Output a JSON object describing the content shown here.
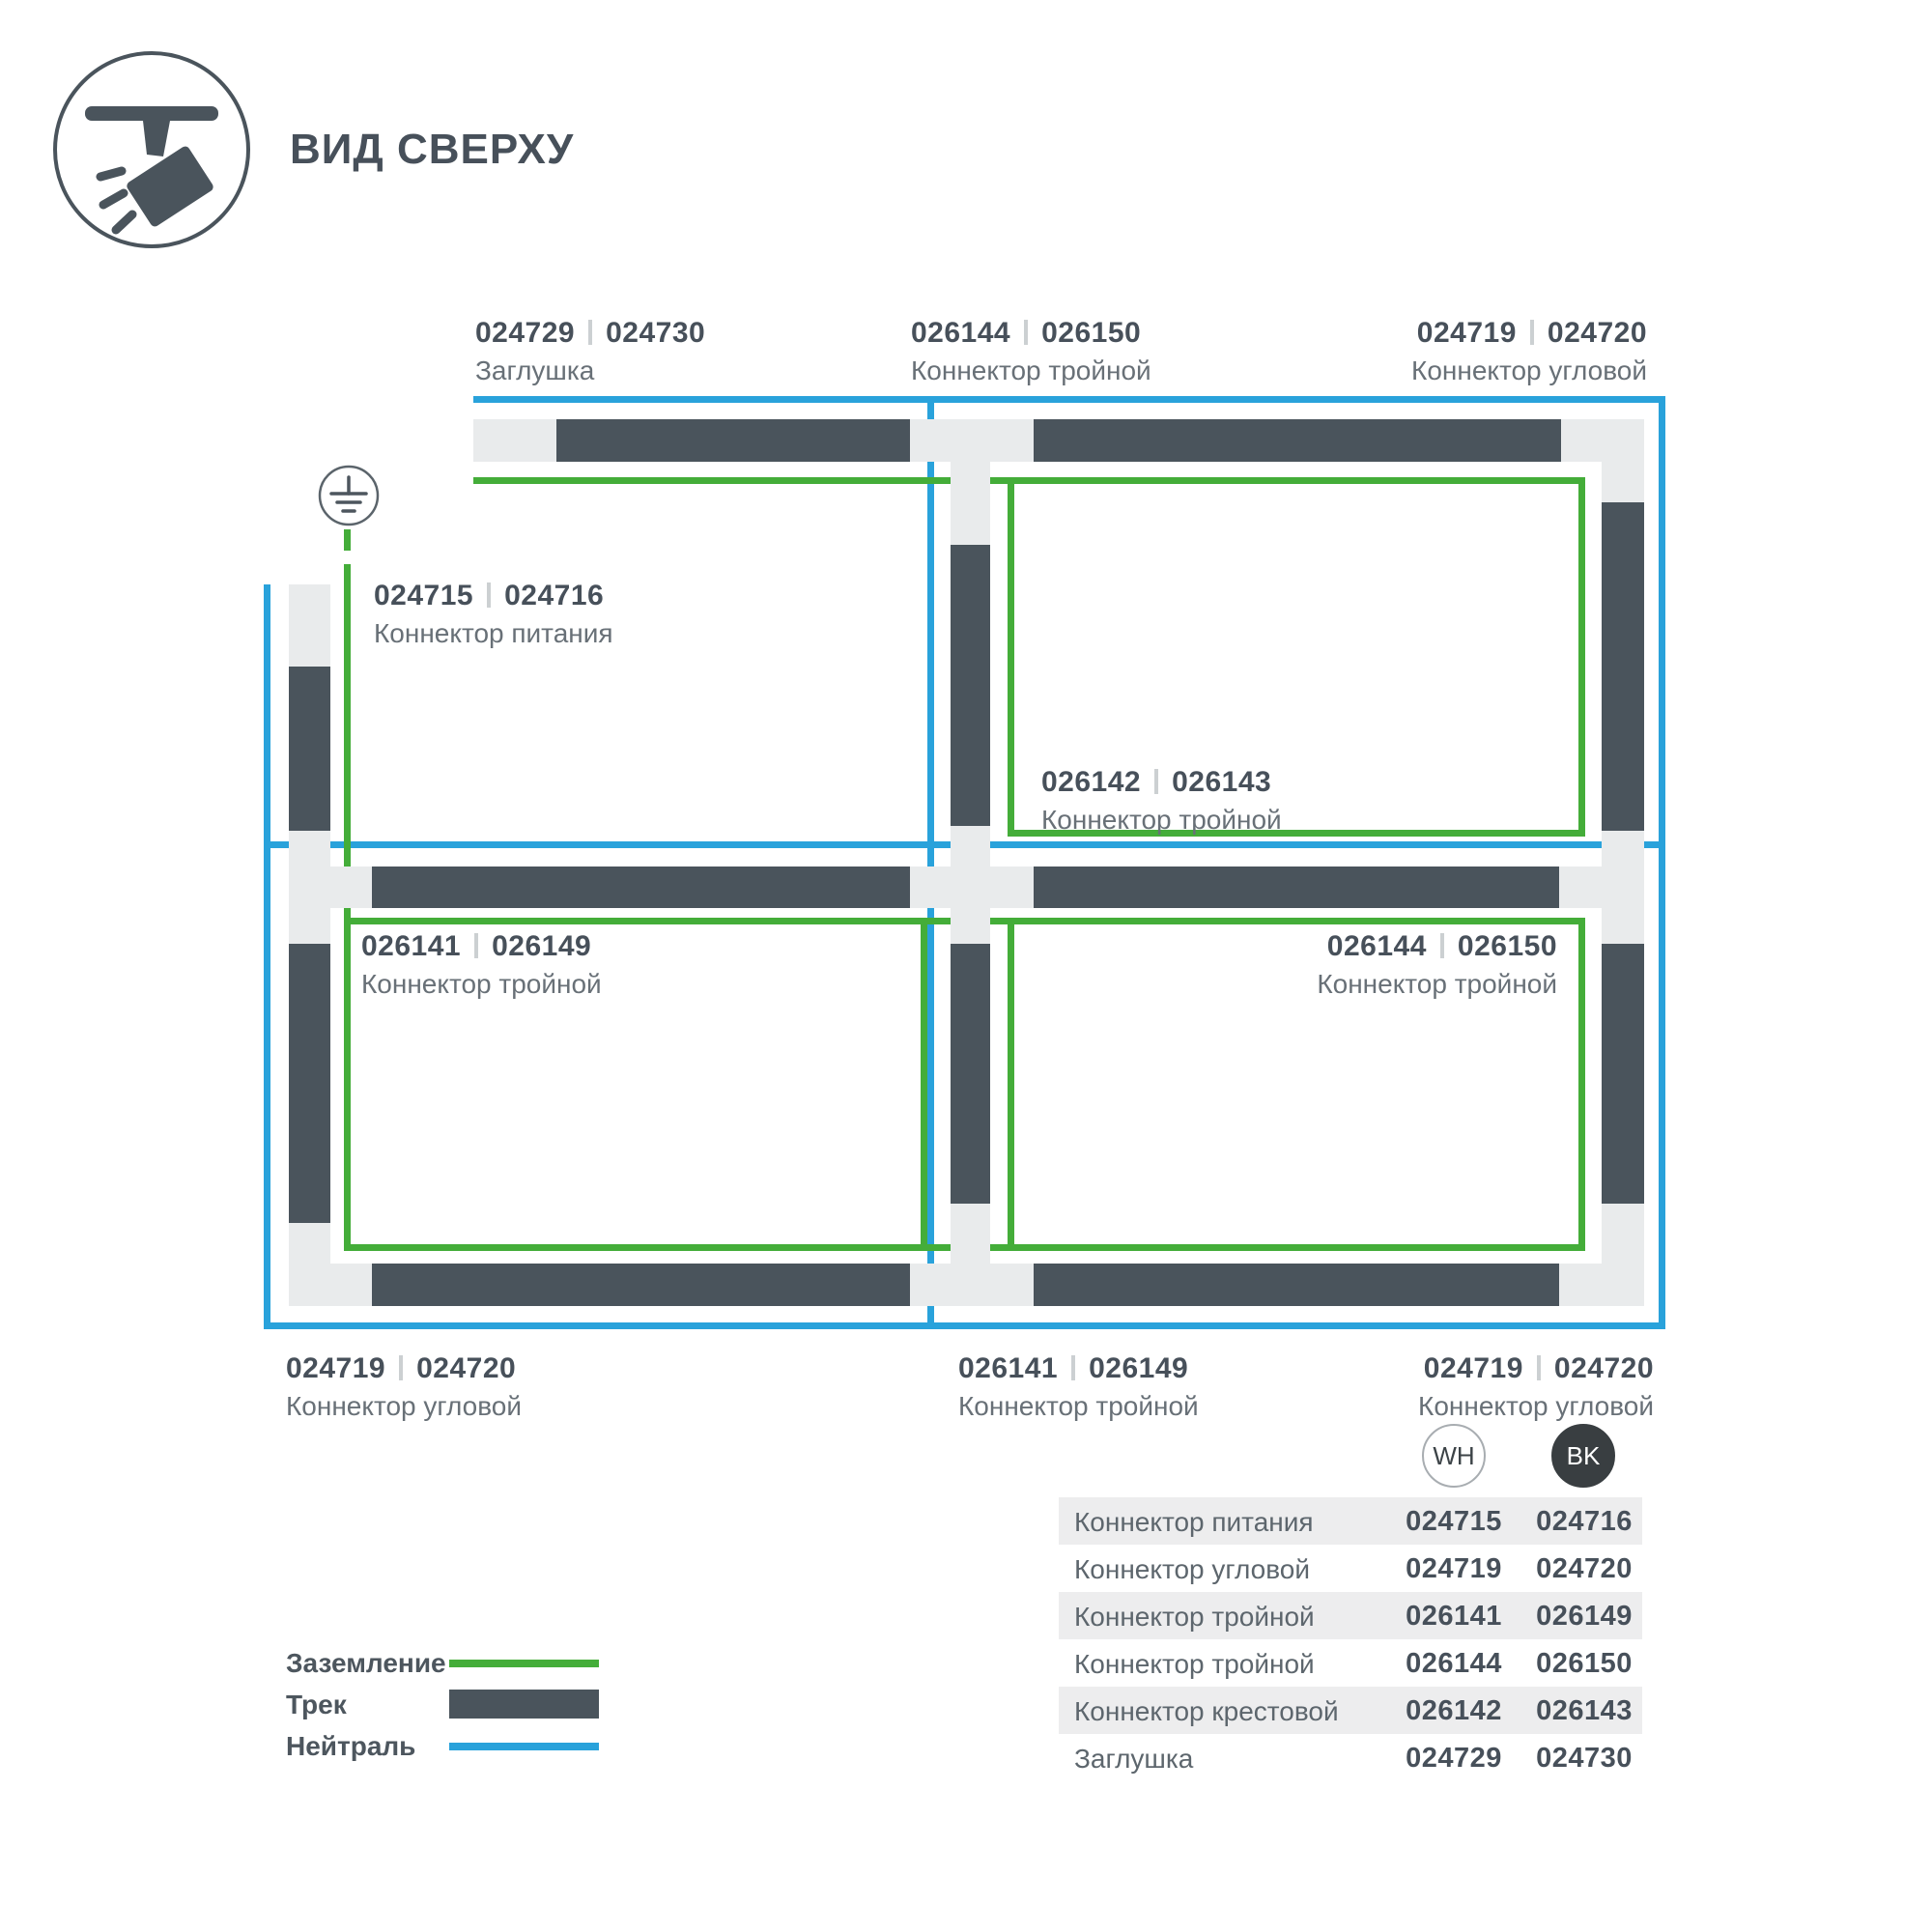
{
  "header": {
    "title": "ВИД СВЕРХУ"
  },
  "diagram": {
    "labels": [
      {
        "pos": "top-left",
        "code_wh": "024729",
        "code_bk": "024730",
        "name": "Заглушка"
      },
      {
        "pos": "top-center",
        "code_wh": "026144",
        "code_bk": "026150",
        "name": "Коннектор тройной"
      },
      {
        "pos": "top-right",
        "code_wh": "024719",
        "code_bk": "024720",
        "name": "Коннектор угловой"
      },
      {
        "pos": "power-feed",
        "code_wh": "024715",
        "code_bk": "024716",
        "name": "Коннектор питания"
      },
      {
        "pos": "cell-top-right",
        "code_wh": "026142",
        "code_bk": "026143",
        "name": "Коннектор тройной"
      },
      {
        "pos": "cell-bottom-left",
        "code_wh": "026141",
        "code_bk": "026149",
        "name": "Коннектор тройной"
      },
      {
        "pos": "cell-bottom-right",
        "code_wh": "026144",
        "code_bk": "026150",
        "name": "Коннектор тройной"
      },
      {
        "pos": "bottom-left",
        "code_wh": "024719",
        "code_bk": "024720",
        "name": "Коннектор угловой"
      },
      {
        "pos": "bottom-center",
        "code_wh": "026141",
        "code_bk": "026149",
        "name": "Коннектор тройной"
      },
      {
        "pos": "bottom-right",
        "code_wh": "024719",
        "code_bk": "024720",
        "name": "Коннектор угловой"
      }
    ]
  },
  "legend": {
    "items": [
      {
        "label": "Заземление",
        "type": "ground-line"
      },
      {
        "label": "Трек",
        "type": "track-bar"
      },
      {
        "label": "Нейтраль",
        "type": "neutral-line"
      }
    ]
  },
  "table": {
    "columns": {
      "wh": "WH",
      "bk": "BK"
    },
    "rows": [
      {
        "name": "Коннектор питания",
        "wh": "024715",
        "bk": "024716"
      },
      {
        "name": "Коннектор угловой",
        "wh": "024719",
        "bk": "024720"
      },
      {
        "name": "Коннектор тройной",
        "wh": "026141",
        "bk": "026149"
      },
      {
        "name": "Коннектор тройной",
        "wh": "026144",
        "bk": "026150"
      },
      {
        "name": "Коннектор крестовой",
        "wh": "026142",
        "bk": "026143"
      },
      {
        "name": "Заглушка",
        "wh": "024729",
        "bk": "024730"
      }
    ]
  },
  "colors": {
    "track": "#4a545c",
    "connector": "#e9ebec",
    "neutral": "#29a2db",
    "ground": "#44ad39",
    "text_dark": "#47505a",
    "text_gray": "#687077",
    "table_stripe": "#ededee",
    "bk_badge": "#393e41"
  }
}
